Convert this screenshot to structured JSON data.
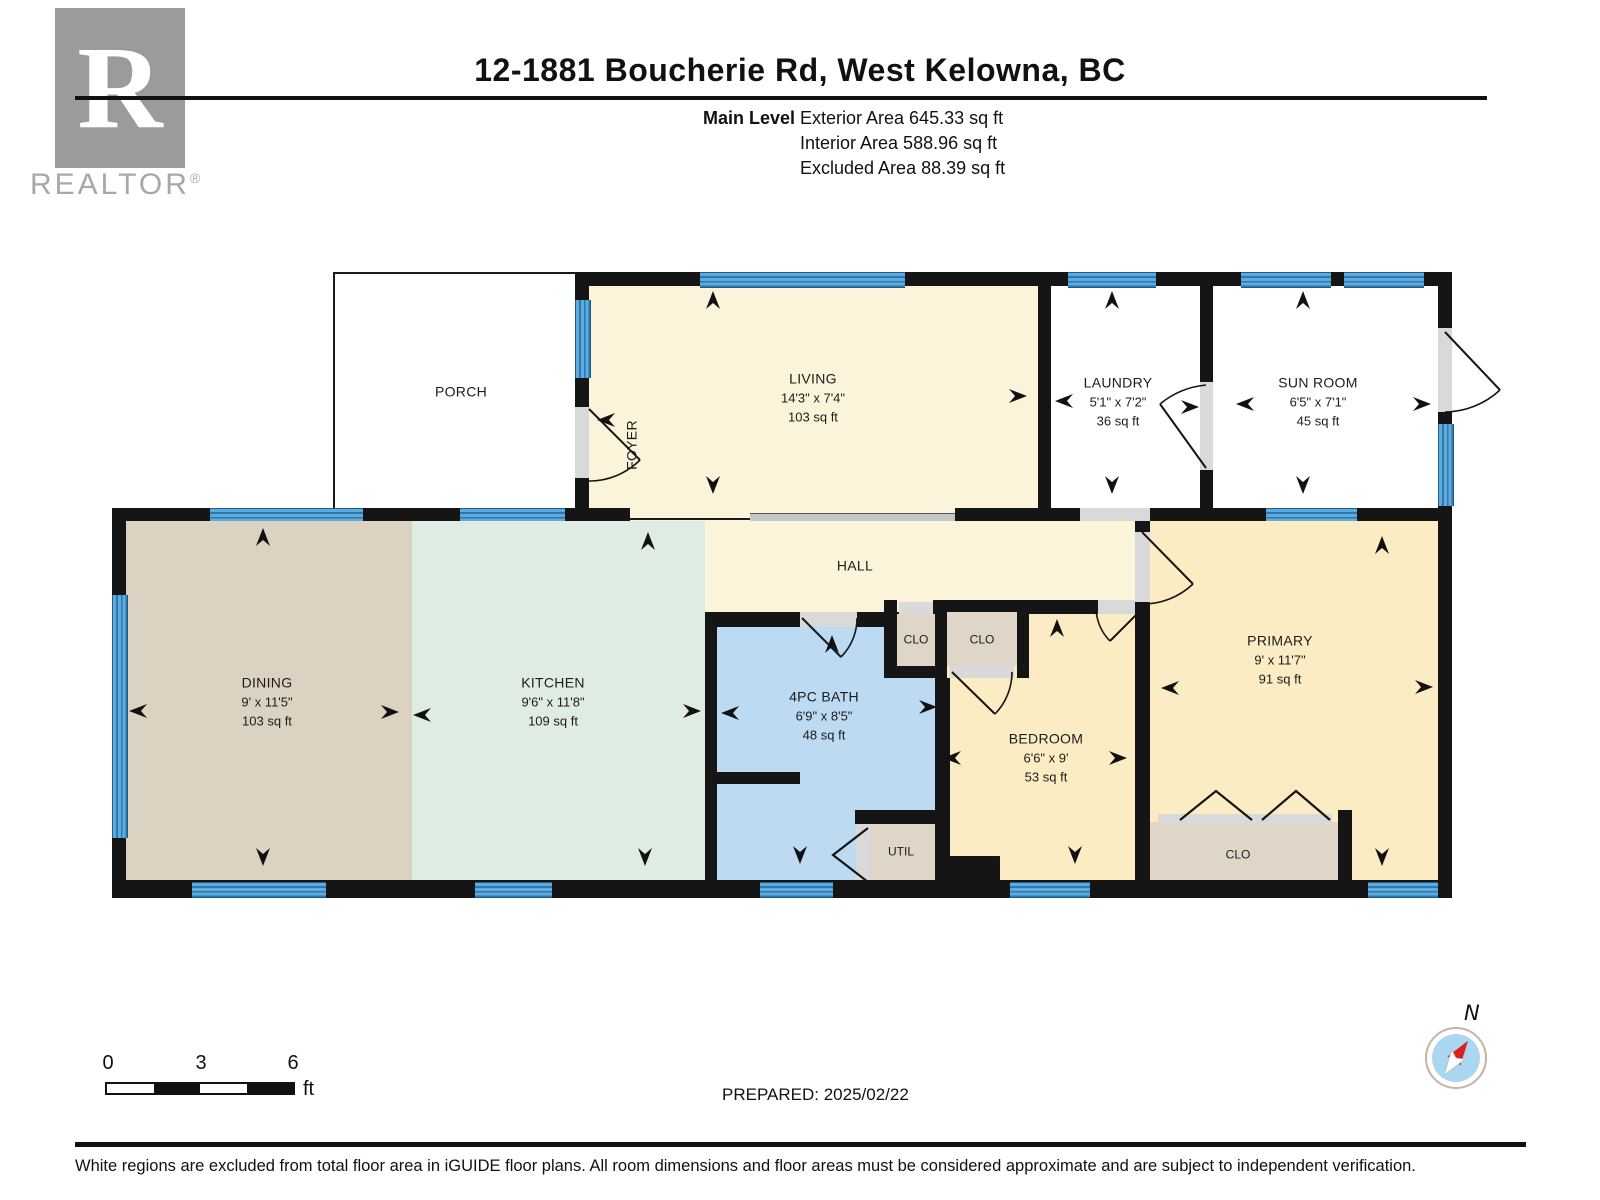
{
  "header": {
    "title": "12-1881 Boucherie Rd, West Kelowna, BC",
    "level_label": "Main Level",
    "areas": [
      "Exterior Area 645.33 sq ft",
      "Interior Area 588.96 sq ft",
      "Excluded Area 88.39 sq ft"
    ]
  },
  "logo": {
    "letter": "R",
    "text": "REALTOR",
    "reg": "®"
  },
  "rooms": {
    "porch": {
      "name": "PORCH"
    },
    "foyer": {
      "name": "FOYER"
    },
    "living": {
      "name": "LIVING",
      "dims": "14'3\" x 7'4\"",
      "area": "103 sq ft"
    },
    "laundry": {
      "name": "LAUNDRY",
      "dims": "5'1\" x 7'2\"",
      "area": "36 sq ft"
    },
    "sunroom": {
      "name": "SUN ROOM",
      "dims": "6'5\" x 7'1\"",
      "area": "45 sq ft"
    },
    "hall": {
      "name": "HALL"
    },
    "dining": {
      "name": "DINING",
      "dims": "9' x 11'5\"",
      "area": "103 sq ft"
    },
    "kitchen": {
      "name": "KITCHEN",
      "dims": "9'6\" x 11'8\"",
      "area": "109 sq ft"
    },
    "bath": {
      "name": "4PC BATH",
      "dims": "6'9\" x 8'5\"",
      "area": "48 sq ft"
    },
    "bedroom": {
      "name": "BEDROOM",
      "dims": "6'6\" x 9'",
      "area": "53 sq ft"
    },
    "primary": {
      "name": "PRIMARY",
      "dims": "9' x 11'7\"",
      "area": "91 sq ft"
    },
    "clo1": {
      "name": "CLO"
    },
    "clo2": {
      "name": "CLO"
    },
    "clo_primary": {
      "name": "CLO"
    },
    "util": {
      "name": "UTIL"
    }
  },
  "scale_bar": {
    "t0": "0",
    "t3": "3",
    "t6": "6",
    "unit": "ft"
  },
  "prepared": "PREPARED: 2025/02/22",
  "compass": {
    "north": "N"
  },
  "footer": "White regions are excluded from total floor area in iGUIDE floor plans. All room dimensions and floor areas must be considered approximate and are subject to independent verification.",
  "colors": {
    "wall": "#151515",
    "window": "#4D9FD8",
    "interior_cream": "#FBF3DA",
    "dining_tan": "#DCD2C2",
    "kitchen_mint": "#DFECE4",
    "bath_blue": "#BCDAF2",
    "bedroom_yellow": "#FBECC3",
    "closet_beige": "#DFD6C7",
    "excluded_white": "#FFFFFF"
  }
}
